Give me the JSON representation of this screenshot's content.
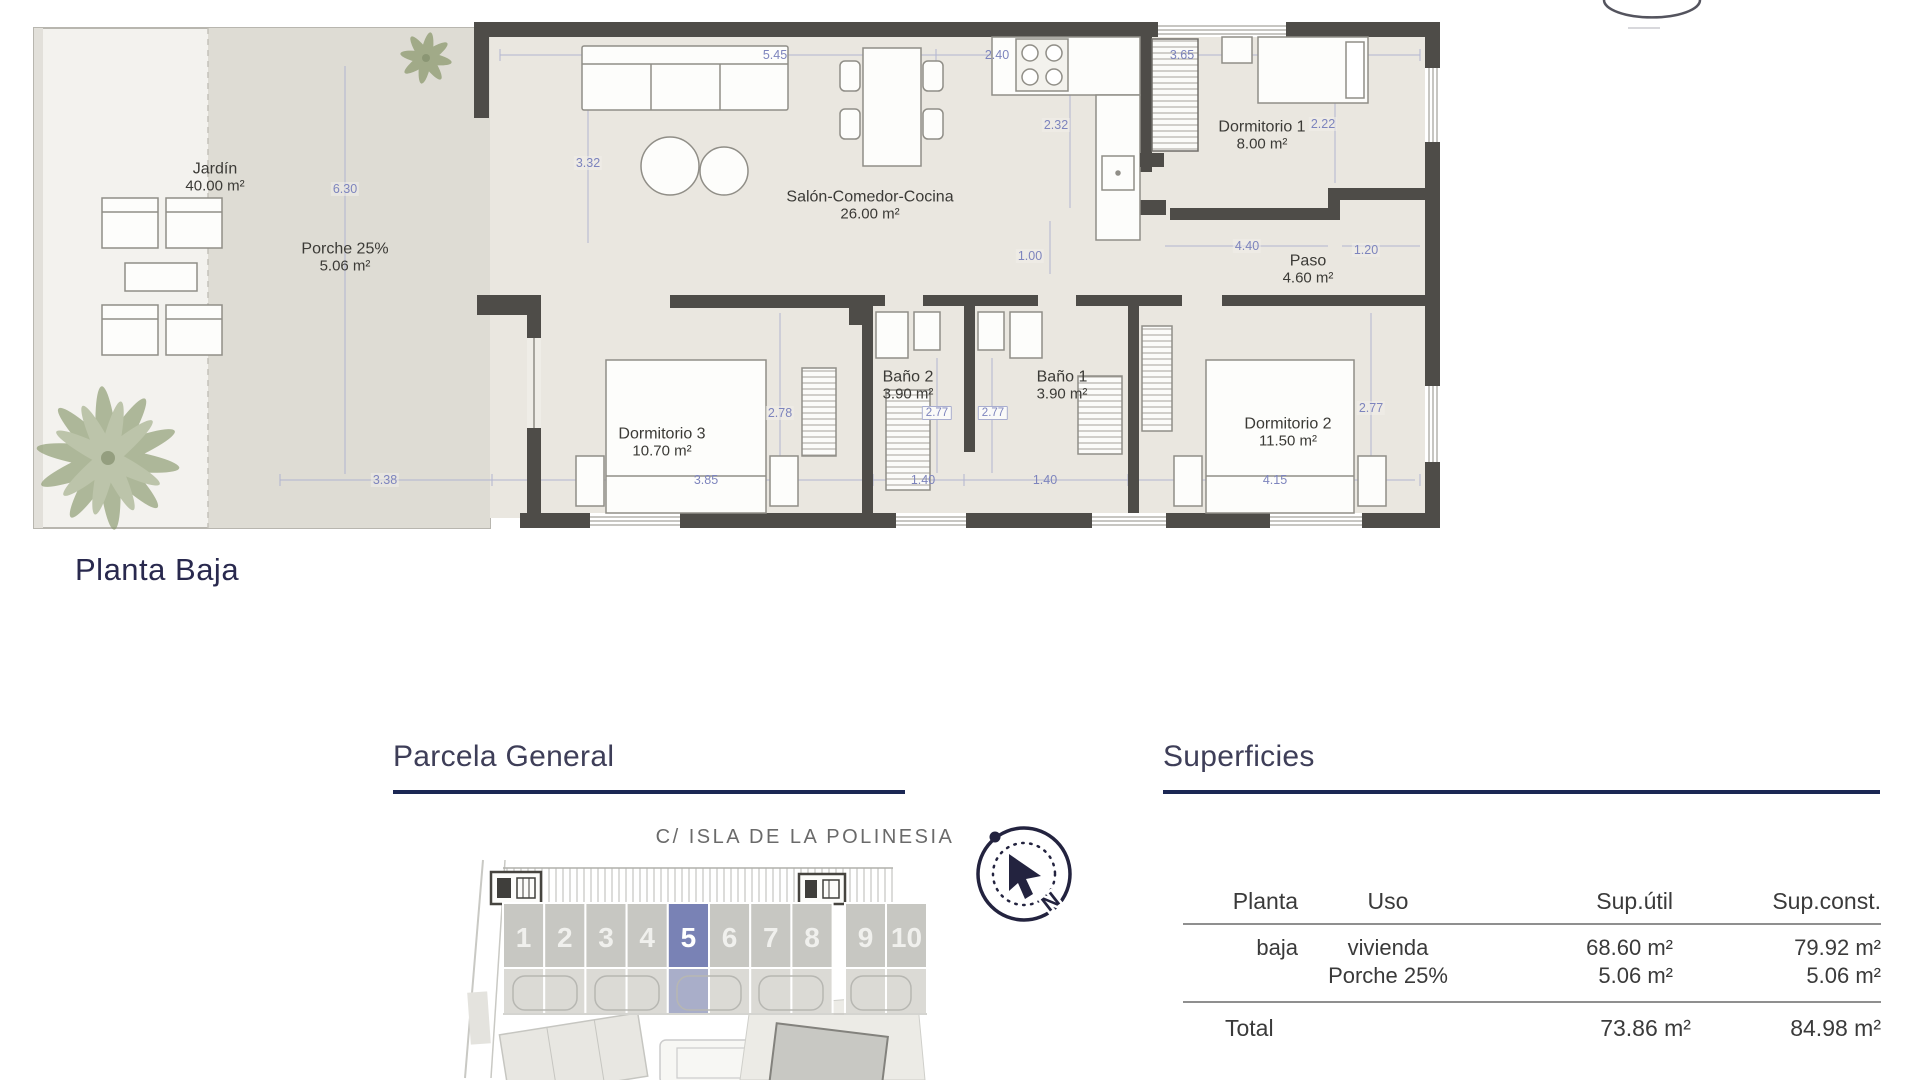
{
  "floor_plan_title": "Planta Baja",
  "rooms": {
    "jardin": {
      "name": "Jardín",
      "area": "40.00 m²"
    },
    "porche": {
      "name": "Porche 25%",
      "area": "5.06 m²"
    },
    "salon": {
      "name": "Salón-Comedor-Cocina",
      "area": "26.00 m²"
    },
    "dormitorio1": {
      "name": "Dormitorio 1",
      "area": "8.00 m²"
    },
    "paso": {
      "name": "Paso",
      "area": "4.60 m²"
    },
    "bano2": {
      "name": "Baño 2",
      "area": "3.90 m²"
    },
    "bano1": {
      "name": "Baño 1",
      "area": "3.90 m²"
    },
    "dormitorio3": {
      "name": "Dormitorio 3",
      "area": "10.70 m²"
    },
    "dormitorio2": {
      "name": "Dormitorio 2",
      "area": "11.50 m²"
    }
  },
  "dimensions": {
    "top_salon": "5.45",
    "top_cocina": "2.40",
    "top_dorm1": "3.65",
    "salon_depth": "3.32",
    "cocina_depth": "2.32",
    "dorm1_depth": "2.22",
    "jardin_depth": "6.30",
    "hall_width": "1.00",
    "paso_width": "4.40",
    "paso_side": "1.20",
    "dorm3_depth": "2.78",
    "bano2_depth": "2.77",
    "bano1_depth": "2.77",
    "dorm2_depth": "2.77",
    "bottom_jardin": "3.38",
    "bottom_dorm3": "3.85",
    "bottom_bano2": "1.40",
    "bottom_bano1": "1.40",
    "bottom_dorm2": "4.15"
  },
  "parcela": {
    "title": "Parcela General",
    "street": "C/ ISLA DE LA POLINESIA",
    "units": [
      "1",
      "2",
      "3",
      "4",
      "5",
      "6",
      "7",
      "8",
      "9",
      "10"
    ],
    "highlighted_unit": "5",
    "compass_north": "N"
  },
  "superficies": {
    "title": "Superficies",
    "columns": {
      "planta": "Planta",
      "uso": "Uso",
      "sup_util": "Sup.útil",
      "sup_const": "Sup.const."
    },
    "rows": [
      {
        "planta": "baja",
        "uso": "vivienda",
        "sup_util": "68.60 m²",
        "sup_const": "79.92 m²"
      },
      {
        "planta": "",
        "uso": "Porche 25%",
        "sup_util": "5.06 m²",
        "sup_const": "5.06 m²"
      }
    ],
    "total": {
      "label": "Total",
      "sup_util": "73.86 m²",
      "sup_const": "84.98 m²"
    }
  },
  "colors": {
    "accent_navy": "#1b2754",
    "dim_blue": "#7d84bd",
    "wall_dark": "#4e4c48",
    "unit_highlight": "#7982b5",
    "porch_gray": "#dedcd4",
    "floor_beige": "#eae7e0"
  }
}
